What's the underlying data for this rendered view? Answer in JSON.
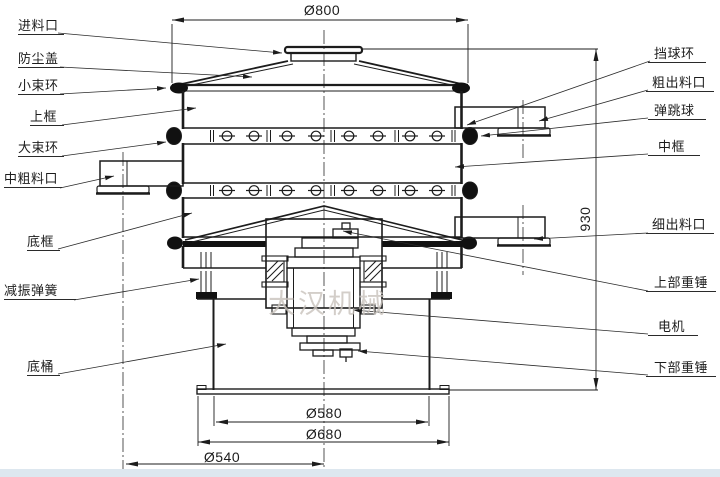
{
  "diagram": {
    "watermark": "大汉机械",
    "labels_left": [
      {
        "id": "feed-inlet",
        "text": "进料口"
      },
      {
        "id": "dust-cover",
        "text": "防尘盖"
      },
      {
        "id": "small-clamp-ring",
        "text": "小束环"
      },
      {
        "id": "upper-frame",
        "text": "上框"
      },
      {
        "id": "large-clamp-ring",
        "text": "大束环"
      },
      {
        "id": "mid-coarse-outlet",
        "text": "中粗料口"
      },
      {
        "id": "bottom-frame",
        "text": "底框"
      },
      {
        "id": "damping-spring",
        "text": "减振弹簧"
      },
      {
        "id": "base-barrel",
        "text": "底桶"
      }
    ],
    "labels_right": [
      {
        "id": "ball-stop-ring",
        "text": "挡球环"
      },
      {
        "id": "coarse-outlet",
        "text": "粗出料口"
      },
      {
        "id": "bouncing-ball",
        "text": "弹跳球"
      },
      {
        "id": "middle-frame",
        "text": "中框"
      },
      {
        "id": "fine-outlet",
        "text": "细出料口"
      },
      {
        "id": "upper-weight",
        "text": "上部重锤"
      },
      {
        "id": "motor",
        "text": "电机"
      },
      {
        "id": "lower-weight",
        "text": "下部重锤"
      }
    ],
    "dimensions": {
      "top_diameter": "Ø800",
      "overall_height": "930",
      "base_barrel_diameter": "Ø580",
      "base_flange_diameter": "Ø680",
      "outlet_diameter": "Ø540"
    },
    "colors": {
      "line": "#1c1c1c",
      "watermark": "#c9c3bc",
      "footer_strip": "#dde7ef",
      "background": "#ffffff"
    }
  }
}
